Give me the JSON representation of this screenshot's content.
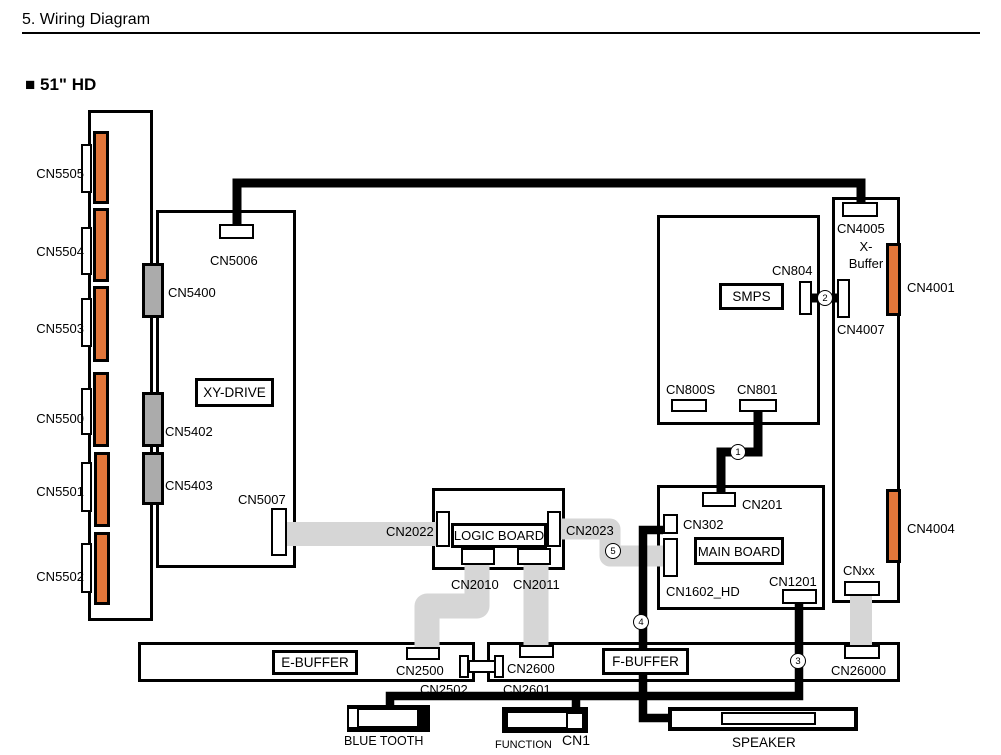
{
  "title": "5.  Wiring Diagram",
  "section": {
    "bullet": "■",
    "label": "51\" HD"
  },
  "boards": {
    "xy_drive": "XY-DRIVE",
    "logic": "LOGIC BOARD",
    "main": "MAIN BOARD",
    "smps": "SMPS",
    "e_buffer": "E-BUFFER",
    "f_buffer": "F-BUFFER",
    "x_buffer_line1": "X-",
    "x_buffer_line2": "Buffer"
  },
  "connectors": {
    "cn5505": "CN5505",
    "cn5504": "CN5504",
    "cn5503": "CN5503",
    "cn5500": "CN5500",
    "cn5501": "CN5501",
    "cn5502": "CN5502",
    "cn5400": "CN5400",
    "cn5402": "CN5402",
    "cn5403": "CN5403",
    "cn5006": "CN5006",
    "cn5007": "CN5007",
    "cn2022": "CN2022",
    "cn2023": "CN2023",
    "cn2010": "CN2010",
    "cn2011": "CN2011",
    "cn2500": "CN2500",
    "cn2502": "CN2502",
    "cn2600": "CN2600",
    "cn2601": "CN2601",
    "cn26000": "CN26000",
    "cn201": "CN201",
    "cn302": "CN302",
    "cn1602_hd": "CN1602_HD",
    "cn1201": "CN1201",
    "cn800s": "CN800S",
    "cn801": "CN801",
    "cn804": "CN804",
    "cn4005": "CN4005",
    "cn4007": "CN4007",
    "cn4001": "CN4001",
    "cn4004": "CN4004",
    "cnxx": "CNxx"
  },
  "modules": {
    "bluetooth": "BLUE TOOTH",
    "function": "FUNCTION",
    "function_cn": "CN1",
    "speaker": "SPEAKER"
  },
  "markers": {
    "m1": "1",
    "m2": "2",
    "m3": "3",
    "m4": "4",
    "m5": "5"
  },
  "colors": {
    "connector_orange": "#E2763A",
    "connector_gray": "#ABABAB",
    "ribbon_gray": "#D6D6D6",
    "wire_black": "#000000"
  }
}
